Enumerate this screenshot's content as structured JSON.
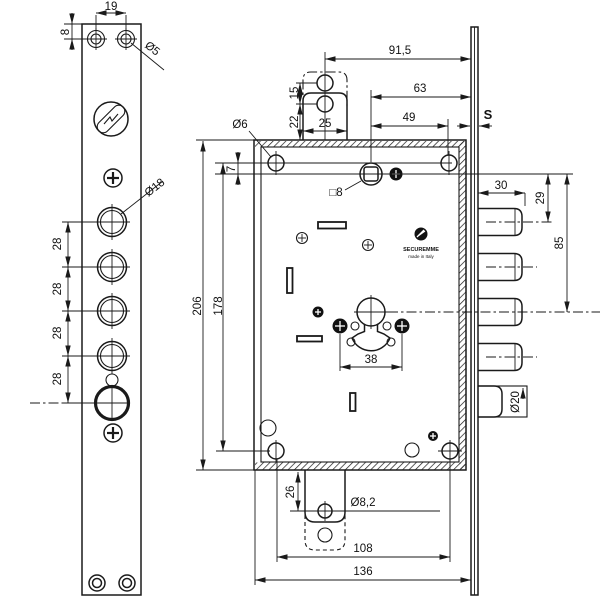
{
  "drawing": {
    "type": "lock-technical-drawing",
    "views": {
      "left": "faceplate front view",
      "right": "lock body side view with bolts"
    }
  },
  "brand": {
    "name": "SECUREMME",
    "origin": "made in Italy"
  },
  "colors": {
    "line": "#1a1a1a",
    "background": "#ffffff"
  },
  "labels": {
    "d19": "19",
    "d8": "8",
    "dia5": "Ø5",
    "dia18": "Ø18",
    "d28a": "28",
    "d28b": "28",
    "d28c": "28",
    "d28d": "28",
    "d91_5": "91,5",
    "d63": "63",
    "d49": "49",
    "s": "S",
    "d15": "15",
    "d22": "22",
    "d25": "25",
    "dia6": "Ø6",
    "d7": "7",
    "d206": "206",
    "d178": "178",
    "sq8": "□8",
    "d30": "30",
    "d29": "29",
    "d85": "85",
    "dia20": "Ø20",
    "d38": "38",
    "d26": "26",
    "dia8_2": "Ø8,2",
    "d108": "108",
    "d136": "136"
  }
}
